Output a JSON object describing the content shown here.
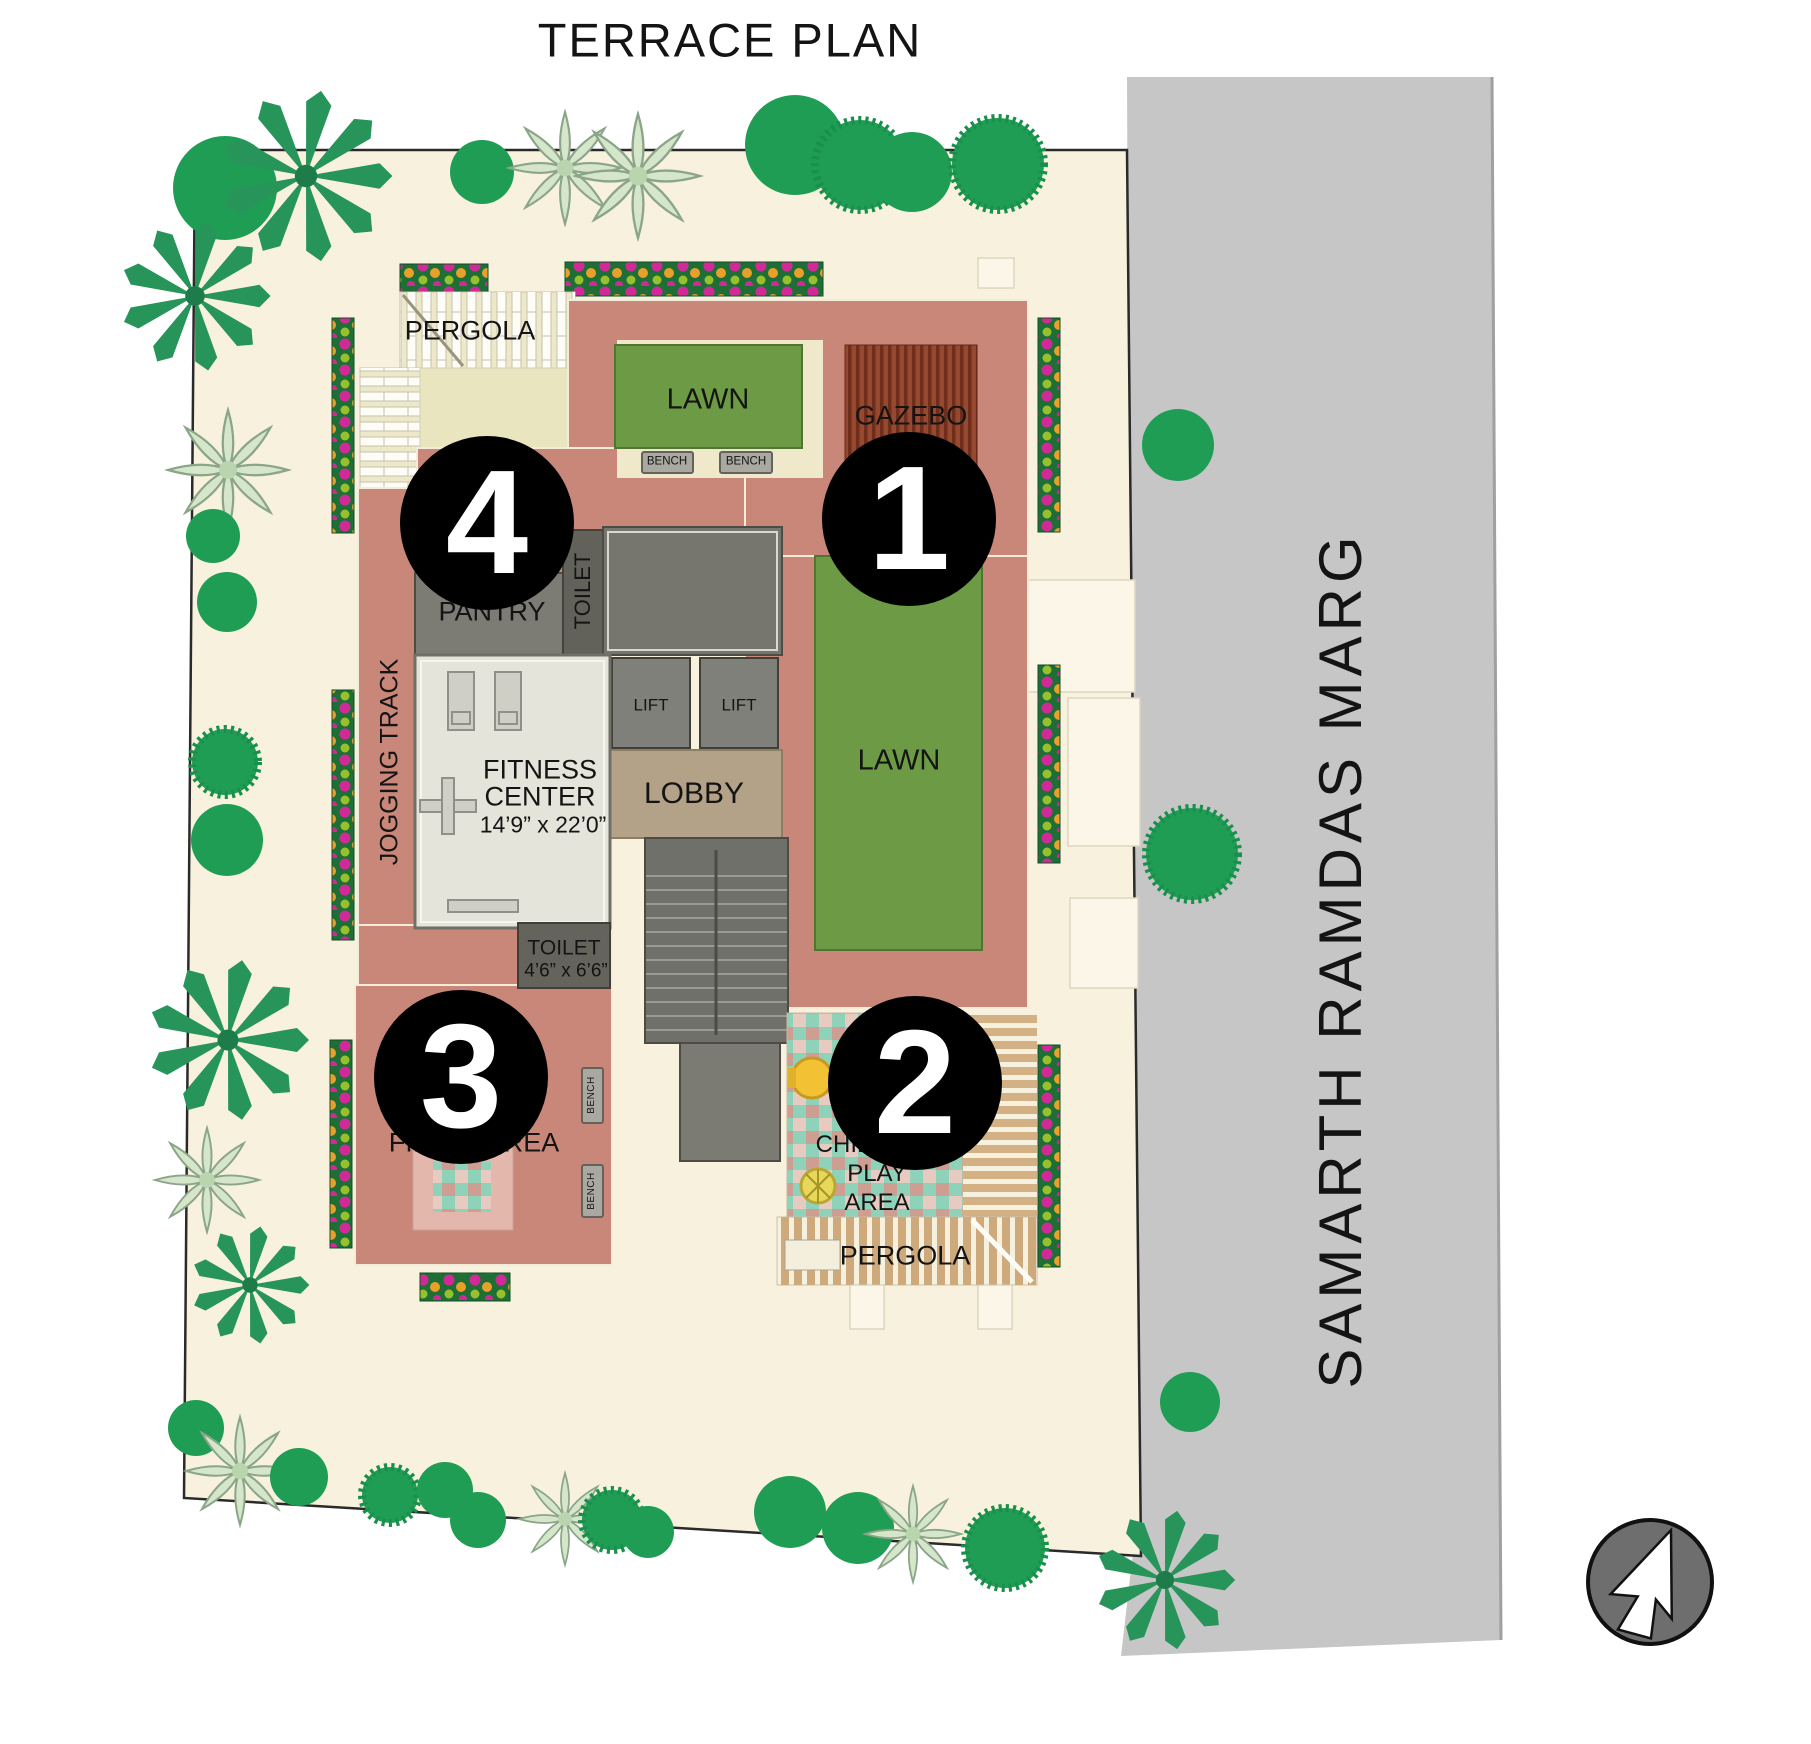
{
  "title": "TERRACE PLAN",
  "road": {
    "name": "SAMARTH RAMDAS MARG"
  },
  "compass": {
    "icon": "north-arrow"
  },
  "markers": [
    {
      "number": "1"
    },
    {
      "number": "2"
    },
    {
      "number": "3"
    },
    {
      "number": "4"
    }
  ],
  "labels": {
    "pergola_top": "PERGOLA",
    "pergola_bottom": "PERGOLA",
    "lawn_top": "LAWN",
    "lawn_strip": "LAWN",
    "gazebo": "GAZEBO",
    "bench": "BENCH",
    "pantry": "PANTRY",
    "toilet_top": "TOILET",
    "lift": "LIFT",
    "lobby": "LOBBY",
    "fitness_line1": "FITNESS",
    "fitness_line2": "CENTER",
    "fitness_dims": "14’9” x  22’0”",
    "toilet_bottom": "TOILET",
    "toilet_bottom_dims": "4’6” x 6’6”",
    "jogging_track": "JOGGING TRACK",
    "fiesta_area": "FIESTA AREA",
    "children_line1": "CHILDREN",
    "children_line2": "PLAY",
    "children_line3": "AREA"
  },
  "colors": {
    "site": "#f7f1dd",
    "road": "#c6c6c6",
    "terrace": "#c9877a",
    "lawn": "#6d9a44",
    "gazebo": "#8a4530",
    "checker_teal": "#8fd2ba",
    "flowerbed": "#1e6e36",
    "tree": "#1f9d55",
    "marker": "#000000"
  }
}
